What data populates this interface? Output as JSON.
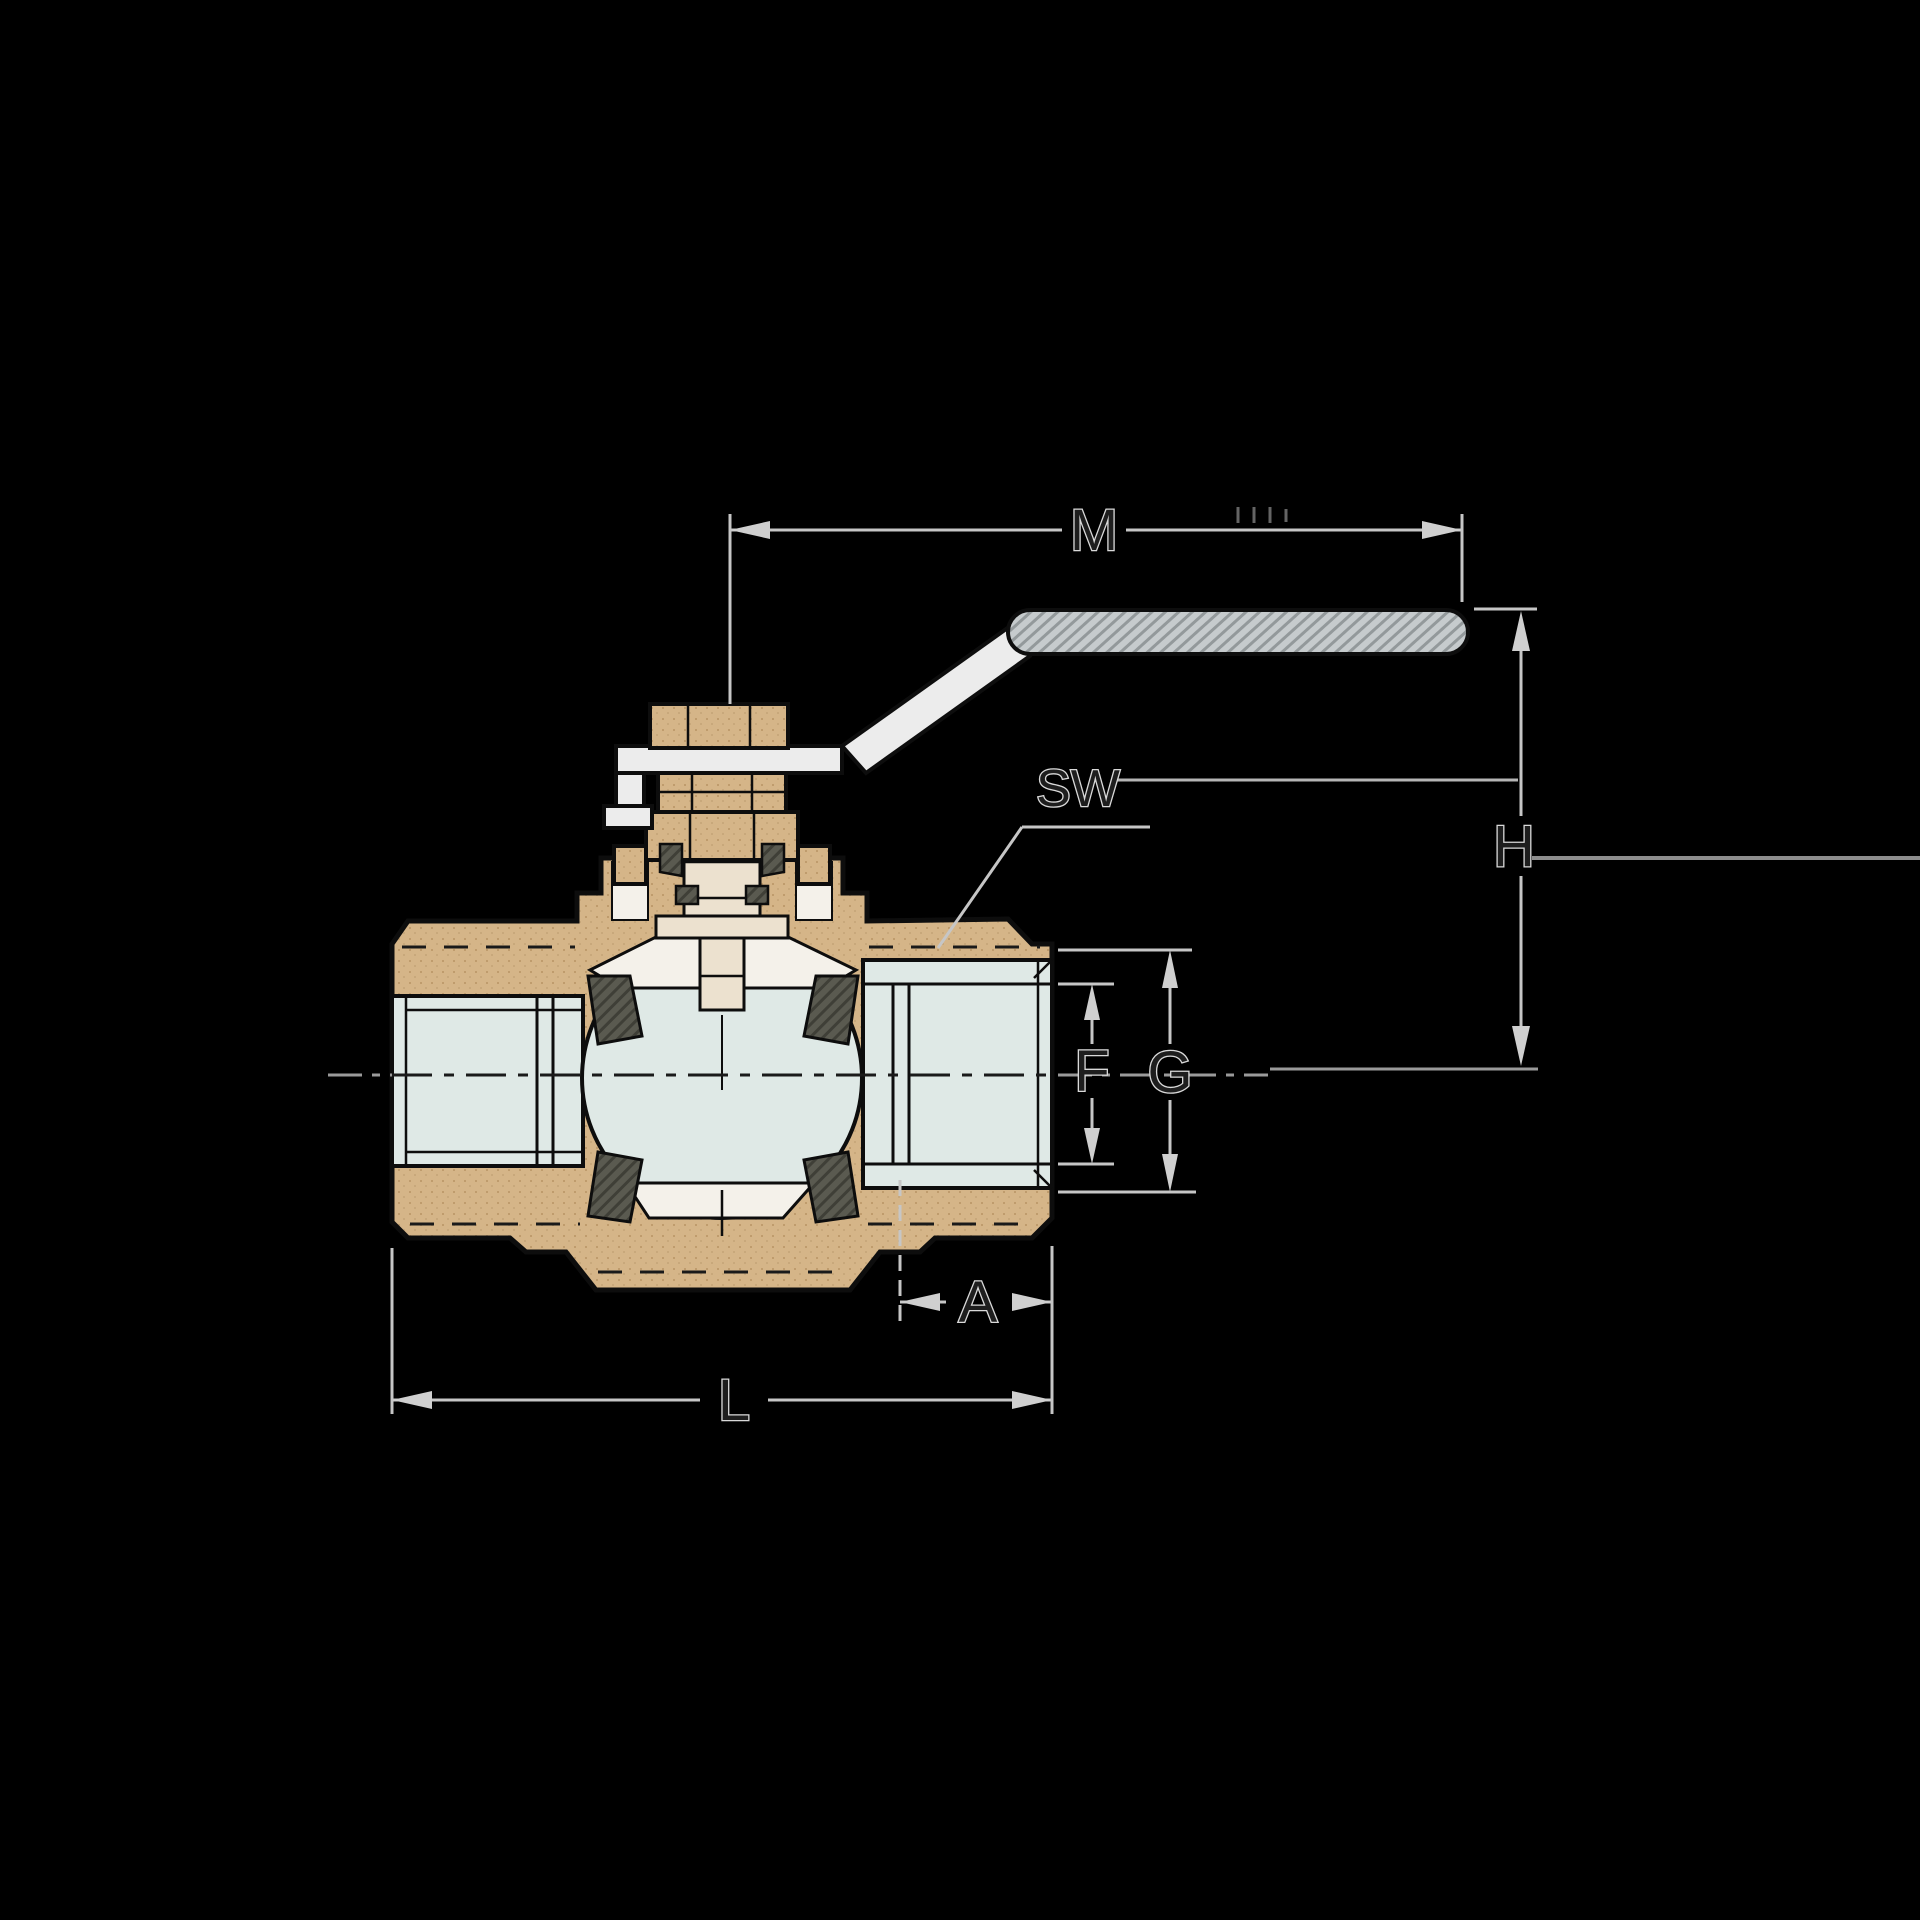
{
  "figure": {
    "type": "technical-drawing",
    "subject": "ball-valve-cross-section"
  },
  "labels": {
    "m": "M",
    "sw": "SW",
    "h": "H",
    "f": "F",
    "g": "G",
    "a": "A",
    "l": "L"
  },
  "colors": {
    "background": "#000000",
    "body_bronze": "#d5b588",
    "body_bronze_speckle": "#bf9c6d",
    "port_bore_blue": "#dfe9e6",
    "seal_dark": "#5a5a50",
    "white_insert": "#f4f1ea",
    "stem_cream": "#ece1cf",
    "handle_metal": "#ececec",
    "grip_gray": "#c6cbcd",
    "dimension_line": "#c6c6c6",
    "label_text": "#1e1e1e",
    "outline_black": "#0d0d0d"
  }
}
